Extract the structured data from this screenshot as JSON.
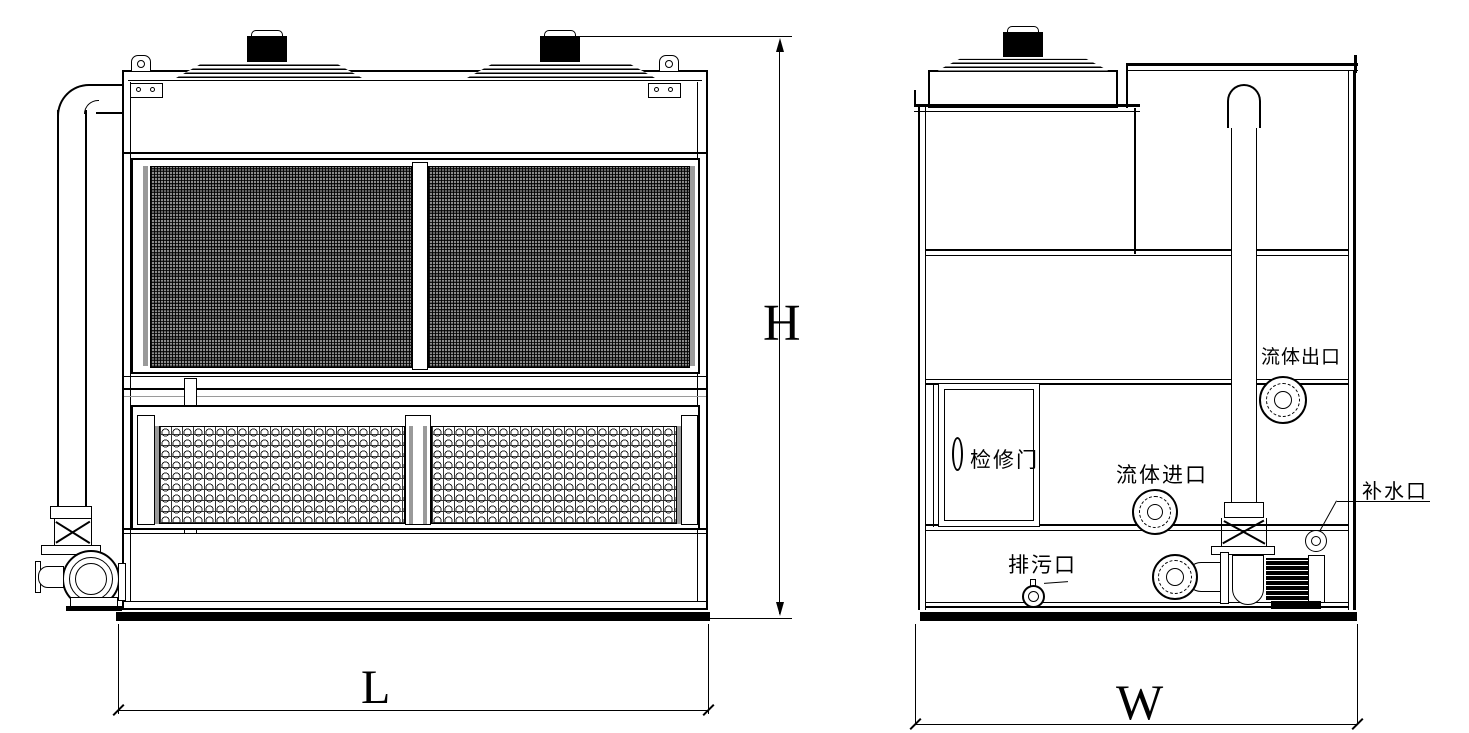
{
  "drawing": {
    "kind": "two-view engineering drawing",
    "line_color": "#000000",
    "background_color": "#ffffff"
  },
  "front_view": {
    "dim_length": "L",
    "dim_height": "H"
  },
  "side_view": {
    "dim_width": "W",
    "label_access_door": "检修门",
    "label_fluid_outlet": "流体出口",
    "label_fluid_inlet": "流体进口",
    "label_makeup_port": "补水口",
    "label_drain_port": "排污口"
  }
}
